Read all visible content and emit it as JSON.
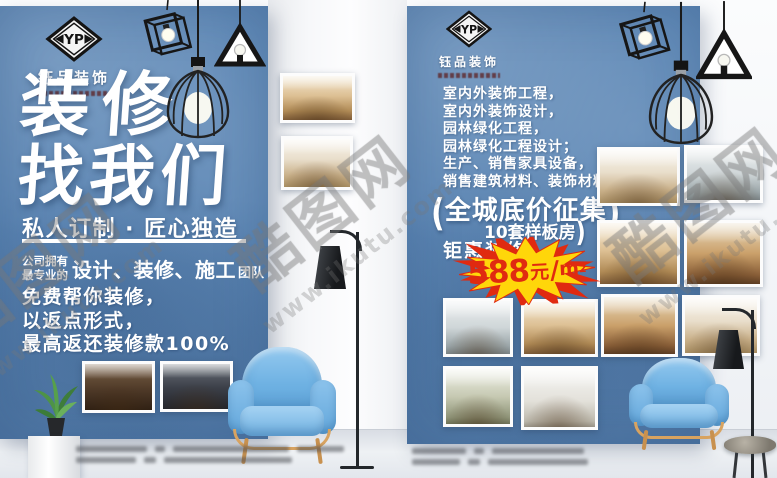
{
  "brand": {
    "initials": "YP",
    "name": "钰品装饰"
  },
  "left_flyer": {
    "headline_line1": "装修",
    "headline_line2": "找我们",
    "tagline": "私人订制 · 匠心独造",
    "team_small_line1": "公司拥有",
    "team_small_line2": "最专业的",
    "team_main": "设计、装修、施工",
    "team_suffix": "团队",
    "body_line1": "免费帮你装修，",
    "body_line2": "以返点形式，",
    "body_line3": "最高返还装修款100%"
  },
  "right_flyer": {
    "services": [
      "室内外装饰工程，",
      "室内外装饰设计，",
      "园林绿化工程，",
      "园林绿化工程设计；",
      "生产、销售家具设备，",
      "销售建筑材料、装饰材料，"
    ],
    "promo_open": "(",
    "promo_title": "全城底价征集",
    "promo_close": ")",
    "promo_sub": "10套样板房",
    "promo_sub_close": ")",
    "promo_tag": "钜惠装修",
    "price": {
      "amount": "588",
      "currency": "元",
      "slash": "/",
      "unit": "m",
      "sup": "2"
    }
  },
  "watermark": {
    "site_cn": "酷图网",
    "site_url": "www.ikutu.com"
  },
  "colors": {
    "flyer_blue": "#5e88b6",
    "star_yellow": "#ffd60a",
    "star_red": "#e02a10",
    "chair_blue": "#6fb2e3"
  }
}
